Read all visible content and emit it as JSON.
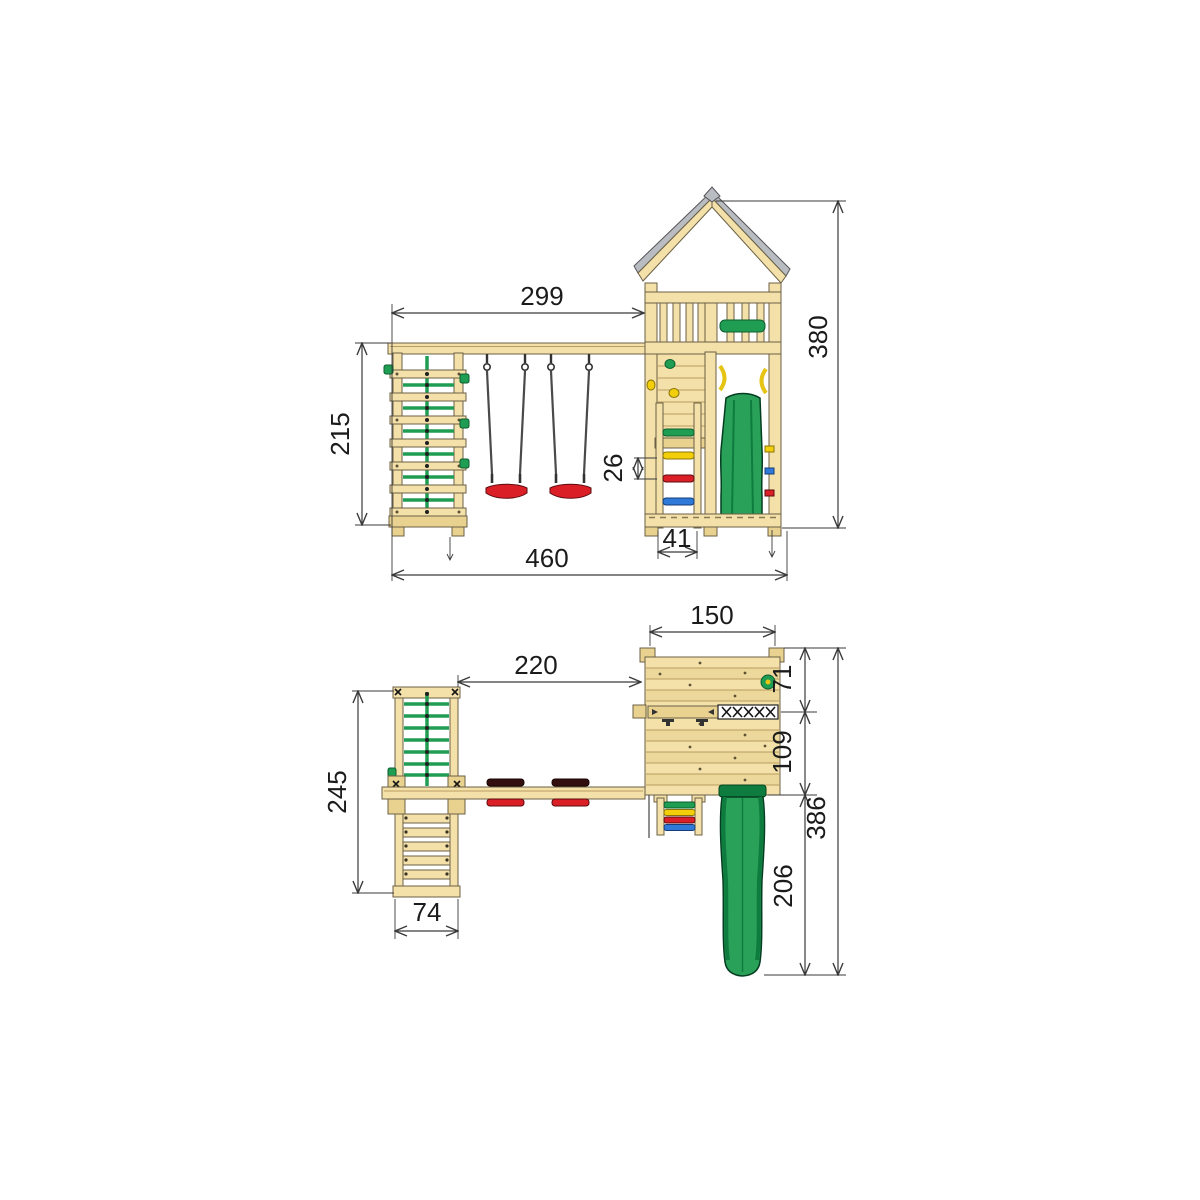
{
  "palette": {
    "wood_light": "#f3e1a9",
    "wood_dark": "#e9d28f",
    "slide_green": "#2aa159",
    "net_green": "#1f9e53",
    "accent_red": "#da1f26",
    "accent_yellow": "#f2cf0a",
    "accent_blue": "#2f79d8",
    "roof_gray": "#b9bdc2",
    "rope_gray": "#4a4a4a",
    "dimension_line": "#3a3a3a",
    "background": "#ffffff"
  },
  "side_view": {
    "dims": {
      "beam_span": "299",
      "total_width": "460",
      "tower_height": "380",
      "climber_height": "215",
      "rung_spacing": "26",
      "ladder_width": "41"
    }
  },
  "plan_view": {
    "dims": {
      "tower_width": "150",
      "beam_span": "220",
      "roof_depth": "71",
      "platform_depth": "109",
      "slide_length": "206",
      "total_depth": "386",
      "climber_length": "245",
      "climber_width": "74"
    }
  }
}
